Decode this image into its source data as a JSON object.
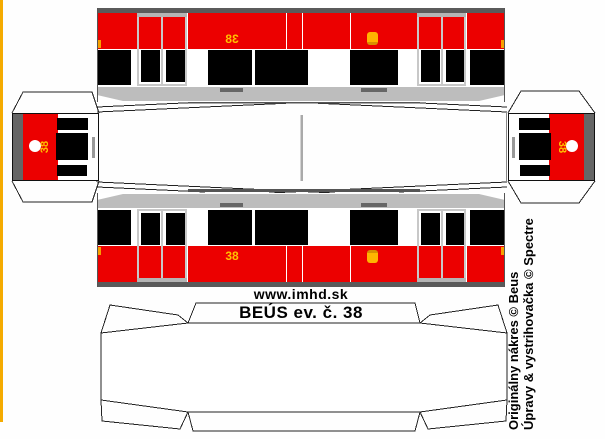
{
  "sheet": {
    "width": 605,
    "height": 439
  },
  "title": {
    "url_label": "www.imhd.sk",
    "model_label": "BEÚS ev. č. 38"
  },
  "credits": {
    "line1": "Originálny nákres © Beus",
    "line2": "Úpravy & vystrihovačka © Spectre"
  },
  "vehicle_number": "38",
  "colors": {
    "red": "#ec0000",
    "yellow_number": "#ffc000",
    "headlight_orange": "#ffb400",
    "marker_orange": "#f7a000",
    "accent_border": "#f5ab00",
    "dark_gray": "#5a5a5a",
    "light_gray": "#bdbdbd",
    "cap_gray": "#666666",
    "door_gray": "#c8c8c8",
    "outline": "#222222"
  },
  "side_view": {
    "number": "38",
    "number_x": 124,
    "headlight_x": 270,
    "windows": [
      {
        "x": 1,
        "w": 33
      },
      {
        "x": 111,
        "w": 44
      },
      {
        "x": 158,
        "w": 53
      },
      {
        "x": 253,
        "w": 48
      },
      {
        "x": 373,
        "w": 35
      }
    ],
    "doors": [
      {
        "x": 40,
        "w": 50
      },
      {
        "x": 320,
        "w": 49
      }
    ],
    "door_windows": [
      {
        "x": 44,
        "w": 19
      },
      {
        "x": 69,
        "w": 19
      },
      {
        "x": 324,
        "w": 19
      },
      {
        "x": 349,
        "w": 18
      }
    ],
    "red_dividers": [
      40,
      65,
      90,
      189,
      205,
      253,
      320,
      344,
      369
    ],
    "roof_marks": [
      {
        "x": 123,
        "w": 23
      },
      {
        "x": 264,
        "w": 26
      }
    ],
    "marker_lights": [
      {
        "x": 0
      },
      {
        "x": 404
      }
    ]
  },
  "cap_view": {
    "number": "38",
    "windows": [
      {
        "x": 44,
        "y": 4,
        "w": 31,
        "h": 12
      },
      {
        "x": 43,
        "y": 19,
        "w": 32,
        "h": 27
      },
      {
        "x": 44,
        "y": 51,
        "w": 30,
        "h": 11
      }
    ],
    "roof_strip": {
      "x": 0,
      "w": 10
    },
    "red_band": {
      "x": 10,
      "w": 35
    },
    "headlamp_circle": {
      "x": 16,
      "y": 26,
      "d": 12
    },
    "handle": {
      "x": 79,
      "y": 23,
      "w": 3,
      "h": 21
    }
  }
}
